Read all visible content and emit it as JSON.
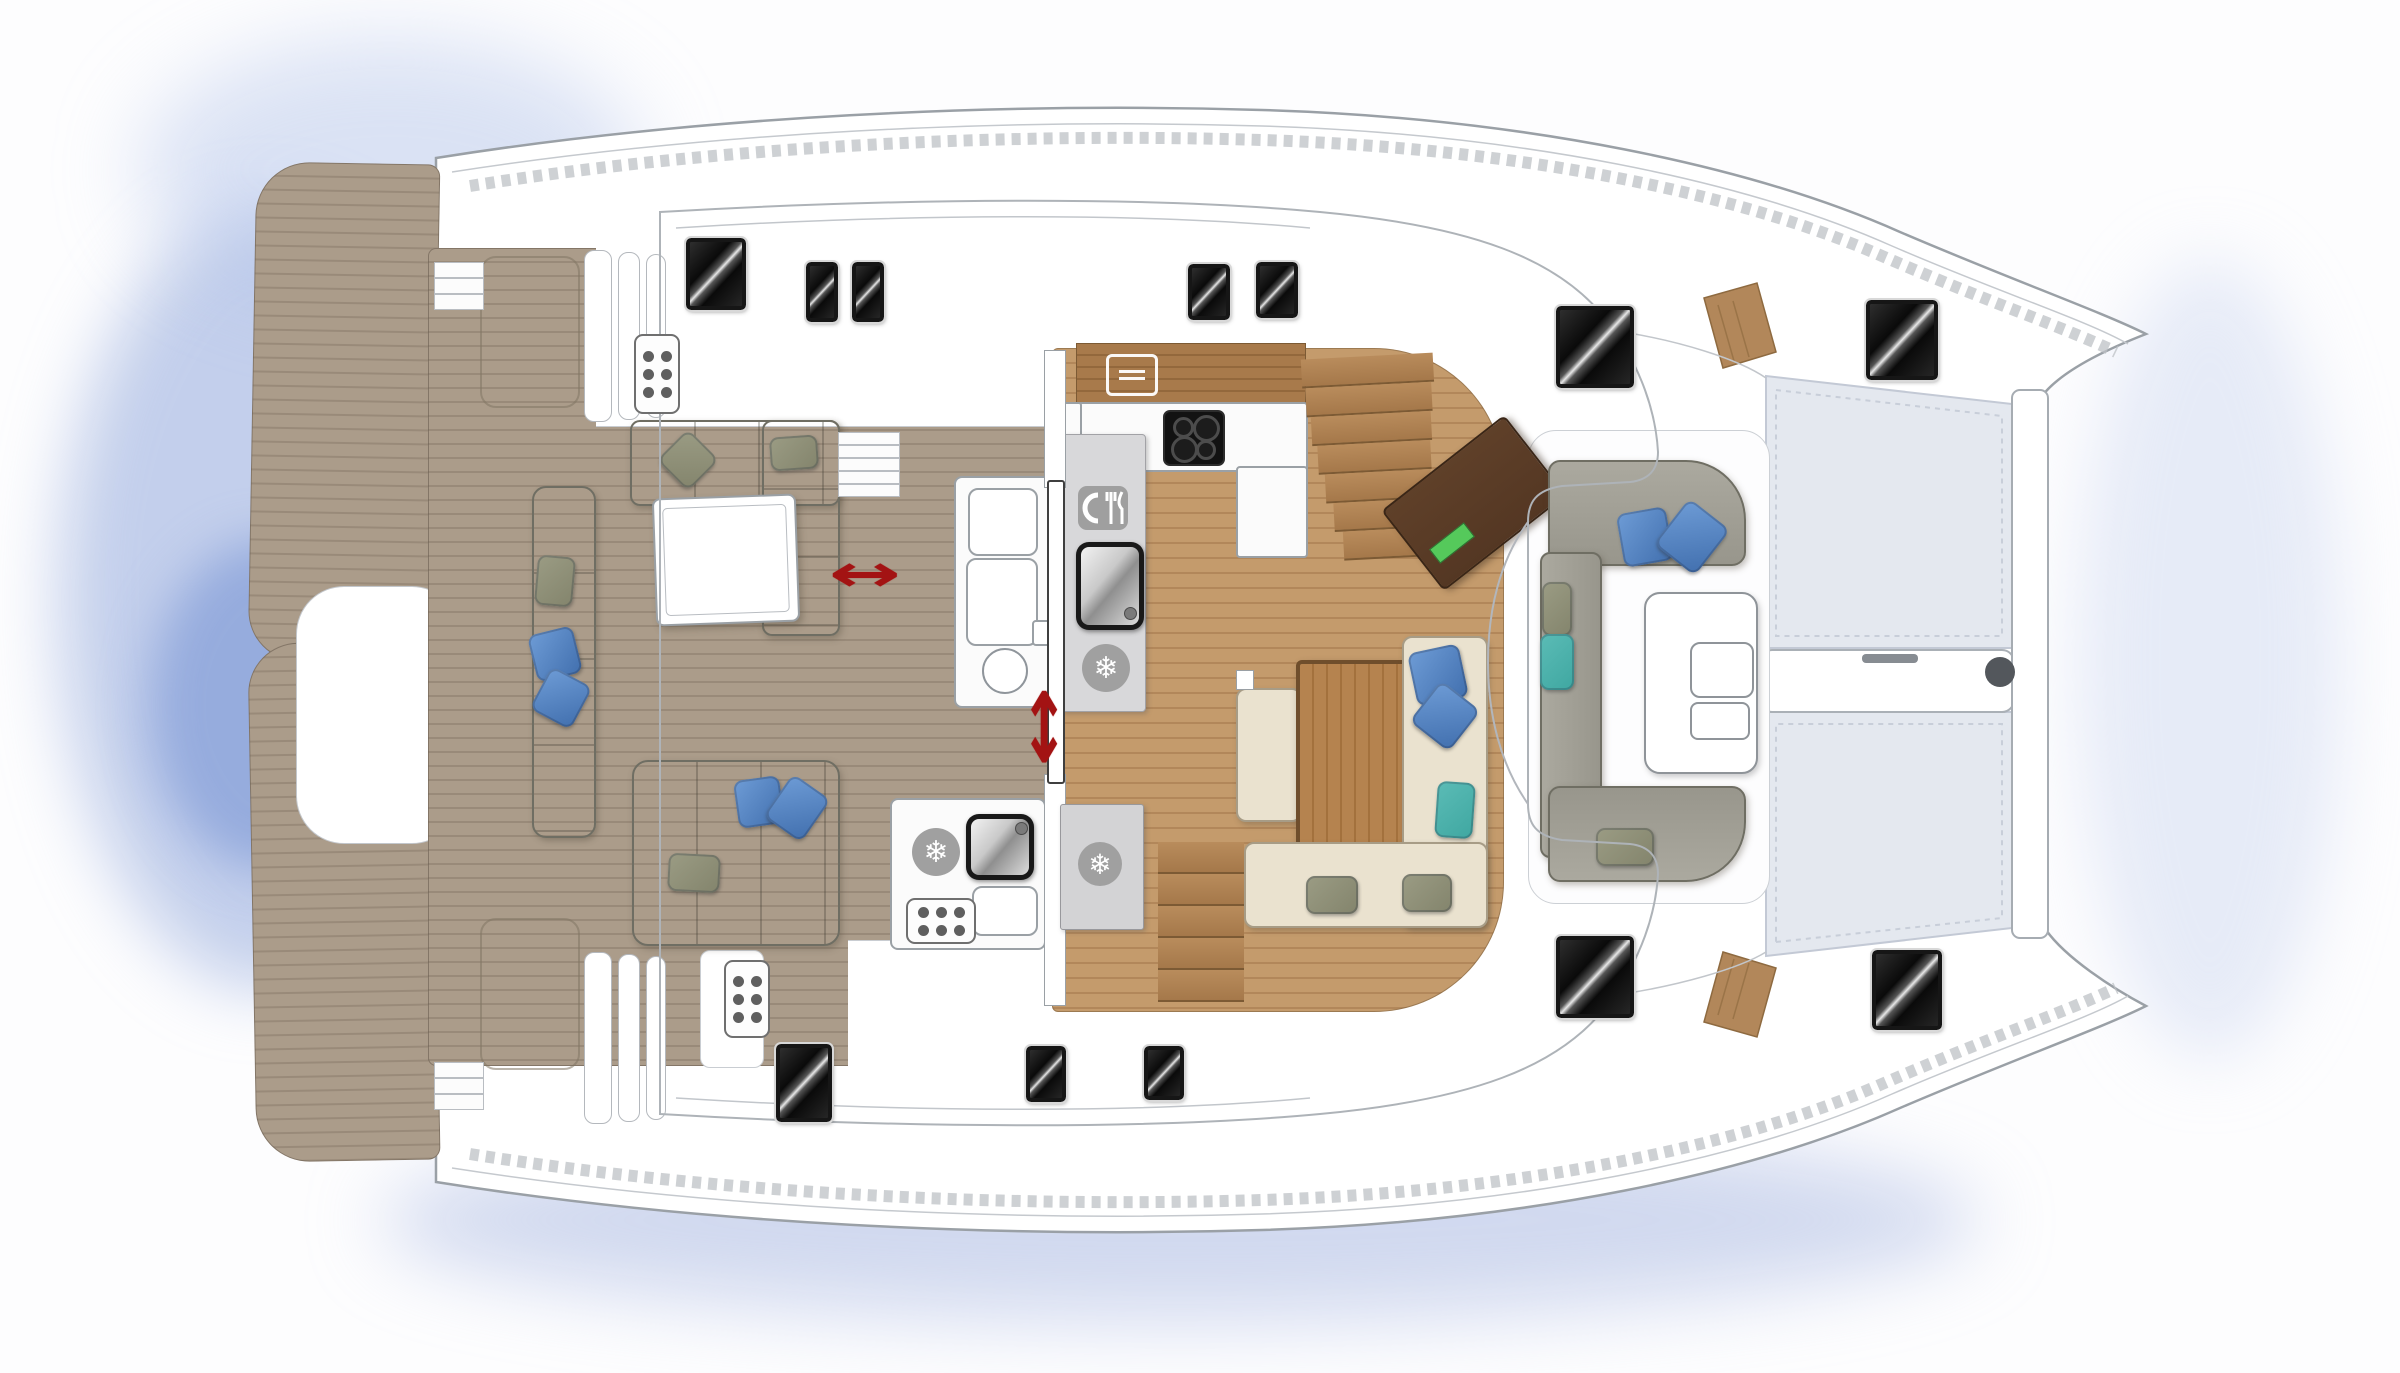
{
  "meta": {
    "description": "Catamaran yacht deck / saloon floor plan, top view, bow to the right"
  },
  "palette": {
    "deck": "#ab9c8a",
    "deck_line": "#998a79",
    "wood_floor": "#c49b6c",
    "wood_floor_line": "#b2875a",
    "wood_counter": "#a87a4b",
    "wood_counter_line": "#93683c",
    "table_wood": "#b5834f",
    "table_wood_line": "#a3713d",
    "cream": "#eae2cf",
    "pillow_blue": "#6e9cd6",
    "pillow_blue2": "#416fae",
    "pillow_teal": "#3fa7a1",
    "pillow_olive": "#83846c",
    "island": "#d8d8da",
    "freezer_gray": "#d3d3d5",
    "hatch_dark": "#0e0e0e",
    "red": "#a31313",
    "tramp": "#e4e8ef",
    "tramp_line": "#c3c9d5",
    "hull_line": "#9aa0a6",
    "roof_line": "#aeb3b8",
    "water": "#b9c8e8",
    "desk_brown": "#543723",
    "desk_green": "#55c95b"
  },
  "icons": {
    "snowflake": "❄",
    "slide_horizontal": "↔",
    "slide_vertical": "↕",
    "dining": "plate-fork-knife",
    "oven": "grill-lines",
    "cooktop": "four-burners",
    "keypad": "six-dots",
    "anchor_roller": "dark-circle"
  }
}
